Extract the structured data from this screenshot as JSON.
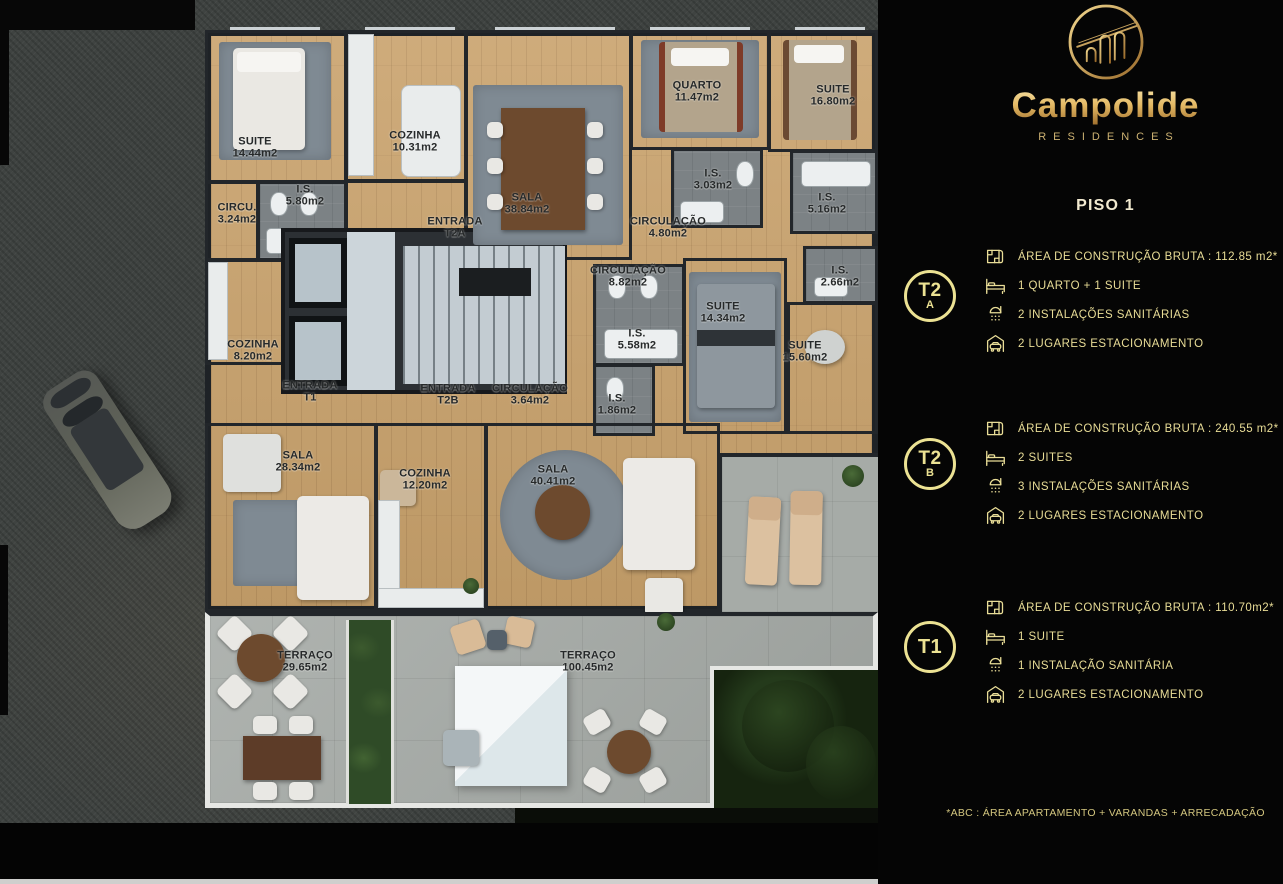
{
  "brand": {
    "name": "Campolide",
    "subtitle": "RESIDENCES",
    "logo_icon": "aqueduct-arches-logo"
  },
  "page": {
    "floor_title": "PISO 1",
    "footnote": "*ABC :  ÁREA APARTAMENTO + VARANDAS + ARRECADAÇÃO"
  },
  "colors": {
    "gold": "#e9dd97",
    "gold_deep": "#9c6c2b",
    "panel_bg": "#050505",
    "wood_floor": "#c9a26c",
    "wall": "#22262a",
    "terrace": "#a6aba7",
    "street": "#3f4341"
  },
  "units": [
    {
      "code": "T2",
      "letter": "A",
      "rows": [
        {
          "icon": "floorplan-icon",
          "text": "ÁREA DE CONSTRUÇÃO BRUTA :  112.85 m2*"
        },
        {
          "icon": "bed-icon",
          "text": "1 QUARTO + 1 SUITE"
        },
        {
          "icon": "shower-icon",
          "text": "2 INSTALAÇÕES SANITÁRIAS"
        },
        {
          "icon": "garage-icon",
          "text": "2 LUGARES ESTACIONAMENTO"
        }
      ]
    },
    {
      "code": "T2",
      "letter": "B",
      "rows": [
        {
          "icon": "floorplan-icon",
          "text": "ÁREA DE CONSTRUÇÃO BRUTA :  240.55 m2*"
        },
        {
          "icon": "bed-icon",
          "text": "2 SUITES"
        },
        {
          "icon": "shower-icon",
          "text": "3 INSTALAÇÕES SANITÁRIAS"
        },
        {
          "icon": "garage-icon",
          "text": "2 LUGARES ESTACIONAMENTO"
        }
      ]
    },
    {
      "code": "T1",
      "letter": "",
      "rows": [
        {
          "icon": "floorplan-icon",
          "text": "ÁREA DE CONSTRUÇÃO BRUTA :  110.70m2*"
        },
        {
          "icon": "bed-icon",
          "text": "1 SUITE"
        },
        {
          "icon": "shower-icon",
          "text": "1 INSTALAÇÃO SANITÁRIA"
        },
        {
          "icon": "garage-icon",
          "text": "2 LUGARES ESTACIONAMENTO"
        }
      ]
    }
  ],
  "plan": {
    "rooms": [
      {
        "name": "SUITE",
        "area": "14.44m2"
      },
      {
        "name": "COZINHA",
        "area": "10.31m2"
      },
      {
        "name": "SALA",
        "area": "38.84m2"
      },
      {
        "name": "QUARTO",
        "area": "11.47m2"
      },
      {
        "name": "SUITE",
        "area": "16.80m2"
      },
      {
        "name": "I.S.",
        "area": "3.03m2"
      },
      {
        "name": "I.S.",
        "area": "5.16m2"
      },
      {
        "name": "CIRCU.",
        "area": "3.24m2"
      },
      {
        "name": "I.S.",
        "area": "5.80m2"
      },
      {
        "name": "ENTRADA",
        "area": "T2A"
      },
      {
        "name": "CIRCULAÇÃO",
        "area": "4.80m2"
      },
      {
        "name": "CIRCULAÇÃO",
        "area": "8.82m2"
      },
      {
        "name": "I.S.",
        "area": "2.66m2"
      },
      {
        "name": "SUITE",
        "area": "14.34m2"
      },
      {
        "name": "I.S.",
        "area": "5.58m2"
      },
      {
        "name": "SUITE",
        "area": "15.60m2"
      },
      {
        "name": "COZINHA",
        "area": "8.20m2"
      },
      {
        "name": "ENTRADA",
        "area": "T1"
      },
      {
        "name": "ENTRADA",
        "area": "T2B"
      },
      {
        "name": "CIRCULAÇÃO",
        "area": "3.64m2"
      },
      {
        "name": "I.S.",
        "area": "1.86m2"
      },
      {
        "name": "SALA",
        "area": "28.34m2"
      },
      {
        "name": "COZINHA",
        "area": "12.20m2"
      },
      {
        "name": "SALA",
        "area": "40.41m2"
      },
      {
        "name": "TERRAÇO",
        "area": "29.65m2"
      },
      {
        "name": "TERRAÇO",
        "area": "100.45m2"
      }
    ]
  }
}
